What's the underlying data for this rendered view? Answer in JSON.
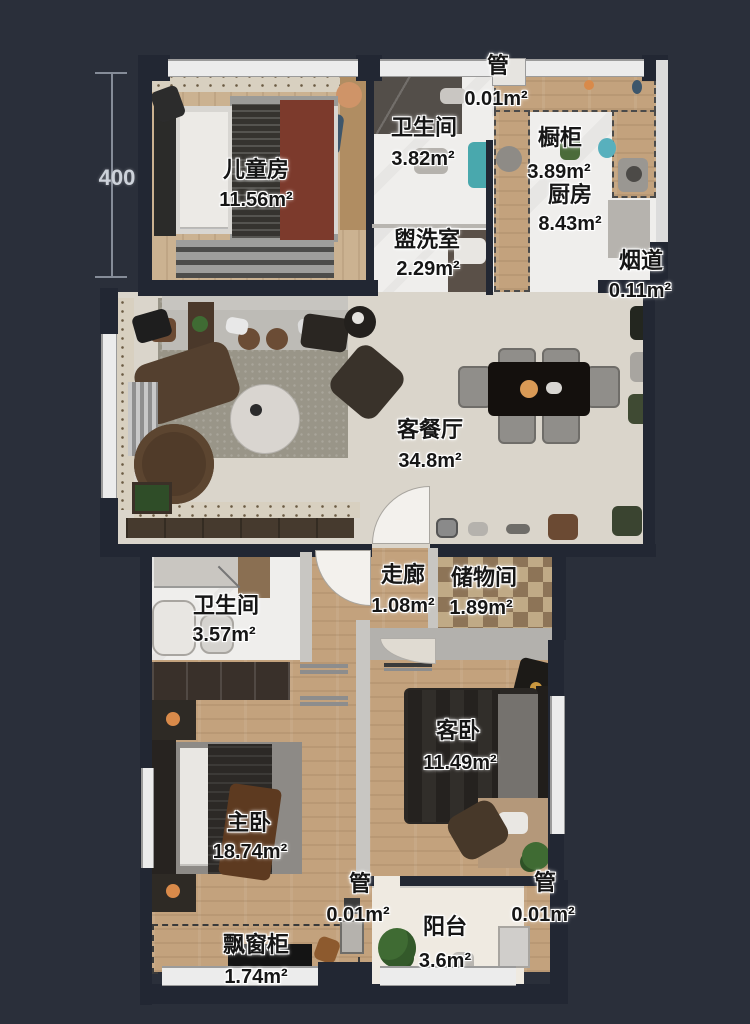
{
  "plan": {
    "dimension": {
      "value": "400"
    },
    "labels": {
      "children_room": {
        "name": "儿童房",
        "area": "11.56m²"
      },
      "bathroom_top": {
        "name": "卫生间",
        "area": "3.82m²"
      },
      "pipe_top": {
        "name": "管",
        "area": "0.01m²"
      },
      "cabinet": {
        "name": "橱柜",
        "area": "3.89m²"
      },
      "kitchen": {
        "name": "厨房",
        "area": "8.43m²"
      },
      "washroom": {
        "name": "盥洗室",
        "area": "2.29m²"
      },
      "flue": {
        "name": "烟道",
        "area": "0.11m²"
      },
      "living_dining": {
        "name": "客餐厅",
        "area": "34.8m²"
      },
      "corridor": {
        "name": "走廊",
        "area": "1.08m²"
      },
      "storage_room": {
        "name": "储物间",
        "area": "1.89m²"
      },
      "bathroom_bottom": {
        "name": "卫生间",
        "area": "3.57m²"
      },
      "master_bedroom": {
        "name": "主卧",
        "area": "18.74m²"
      },
      "guest_bedroom": {
        "name": "客卧",
        "area": "11.49m²"
      },
      "pipe_bottom_mid": {
        "name": "管",
        "area": "0.01m²"
      },
      "pipe_bottom_right": {
        "name": "管",
        "area": "0.01m²"
      },
      "balcony": {
        "name": "阳台",
        "area": "3.6m²"
      },
      "bay_window_cabinet": {
        "name": "飘窗柜",
        "area": "1.74m²"
      }
    },
    "colors": {
      "background": "#2a2f3a",
      "wall_dark": "#222733",
      "wood_floor": "#c3a27d",
      "tile_floor": "#efeeec",
      "living_floor": "#dad5cb",
      "accent_red": "#7c3a2c",
      "plant_green": "#3f6b33",
      "teal_appliance": "#49a8ad"
    }
  }
}
